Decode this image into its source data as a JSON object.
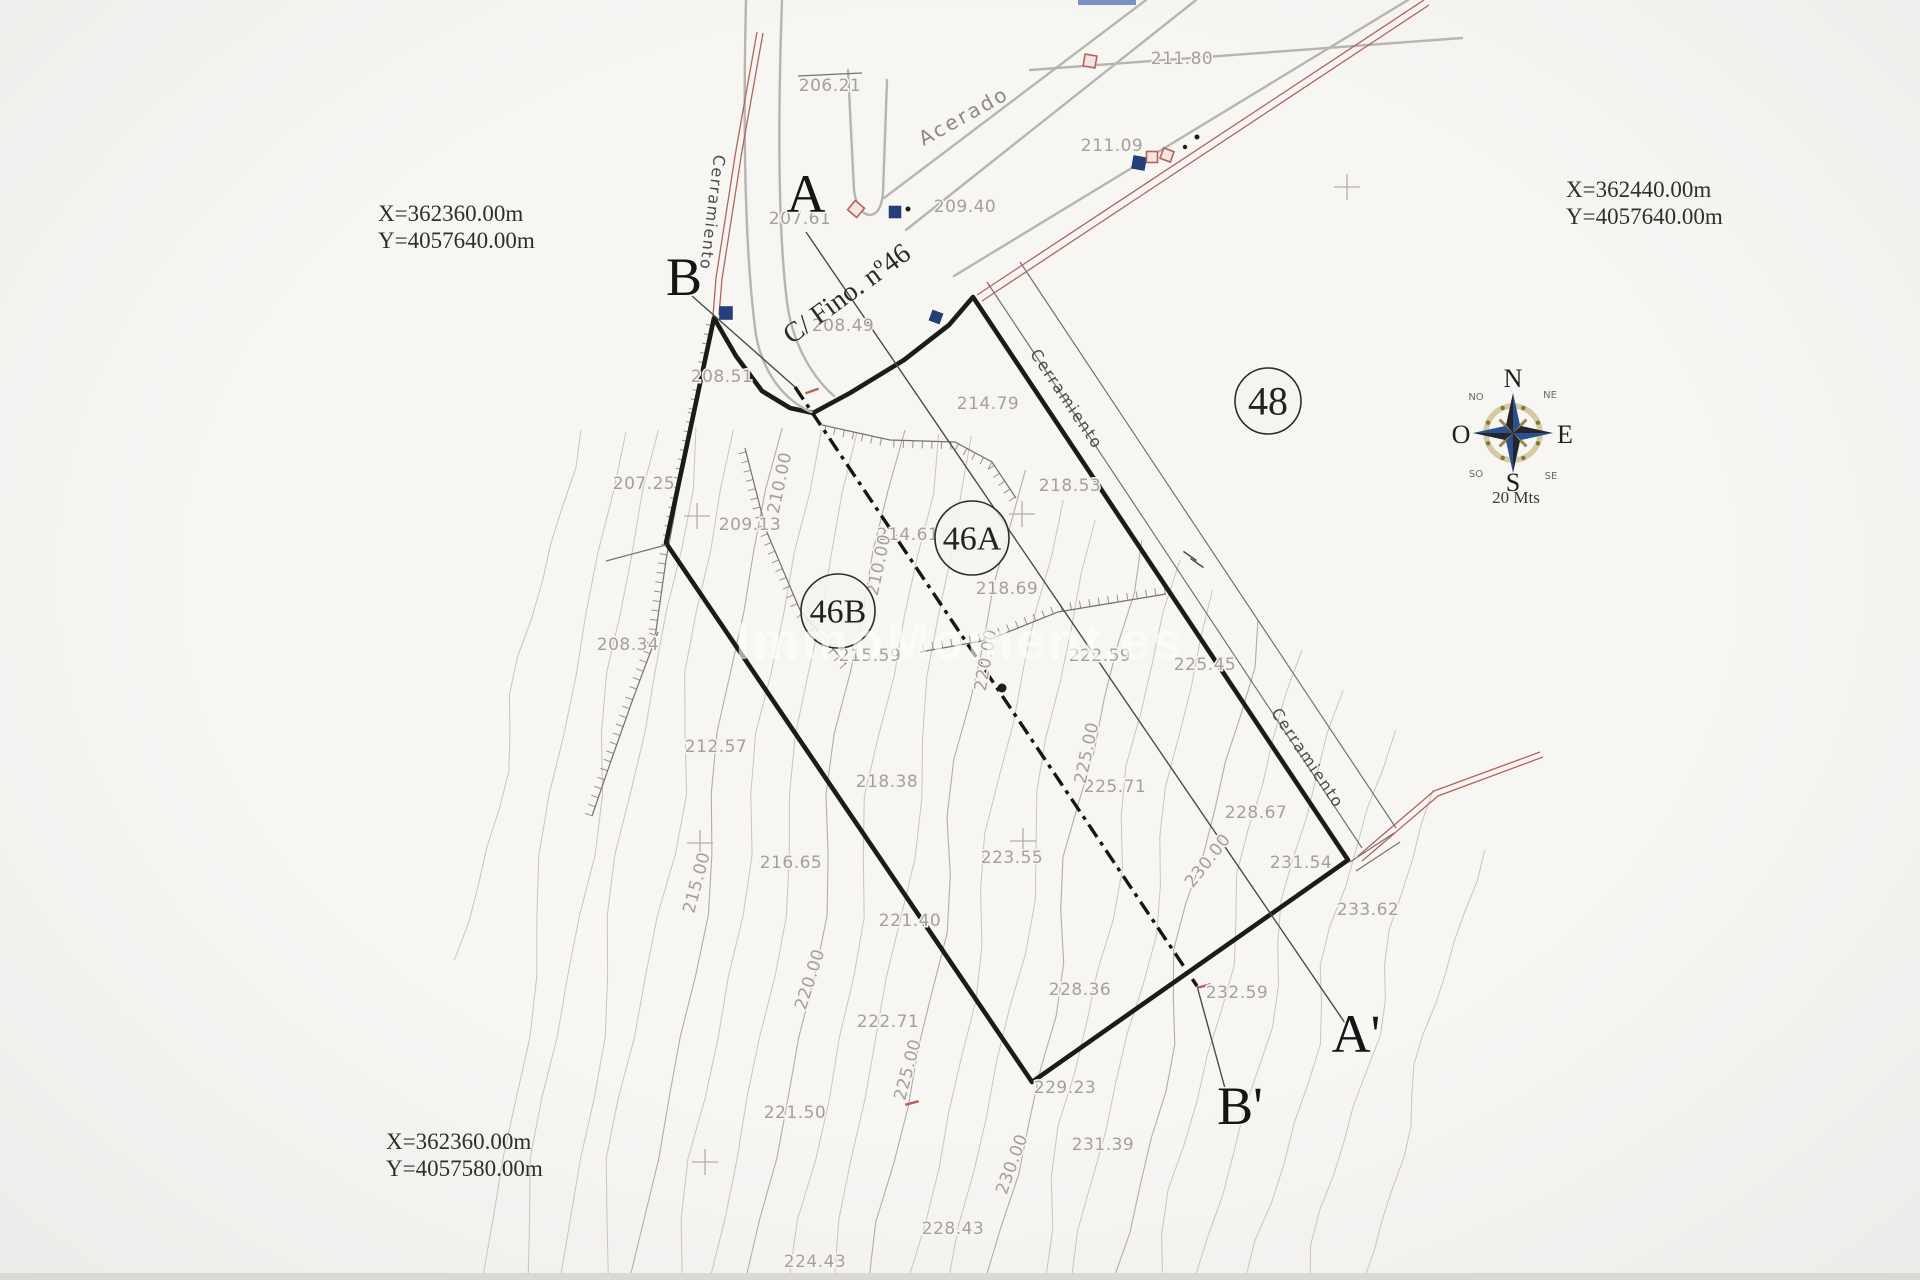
{
  "watermark": {
    "text": "ImmoMoment.es"
  },
  "coords": {
    "tl": {
      "x_label": "X=362360.00m",
      "y_label": "Y=4057640.00m"
    },
    "tr": {
      "x_label": "X=362440.00m",
      "y_label": "Y=4057640.00m"
    },
    "bl": {
      "x_label": "X=362360.00m",
      "y_label": "Y=4057580.00m"
    }
  },
  "compass": {
    "cx": 1513,
    "cy": 433,
    "cardinals": {
      "n": "N",
      "e": "E",
      "s": "S",
      "o": "O"
    },
    "intercardinals": {
      "no": "NO",
      "ne": "NE",
      "so": "SO",
      "se": "SE"
    },
    "scale_label": "20 Mts"
  },
  "colors": {
    "boundary": "#1b1b1b",
    "fence_red": "#b4635c",
    "marker_blue": "#23407c",
    "contour": "#c9c5bd",
    "paper": "#f4f3f0",
    "compass_blue": "#2c4f8f",
    "compass_gold": "#8a7433"
  },
  "parcel_circles": [
    {
      "label": "48",
      "x": 1268,
      "y": 401,
      "r": 33,
      "fs": 40
    },
    {
      "label": "46A",
      "x": 972,
      "y": 538,
      "r": 37,
      "fs": 34
    },
    {
      "label": "46B",
      "x": 838,
      "y": 611,
      "r": 37,
      "fs": 34
    }
  ],
  "section_letters": [
    {
      "label": "A",
      "x": 806,
      "y": 212
    },
    {
      "label": "B",
      "x": 684,
      "y": 295
    },
    {
      "label": "A'",
      "x": 1356,
      "y": 1052
    },
    {
      "label": "B'",
      "x": 1240,
      "y": 1124
    }
  ],
  "street_labels": [
    {
      "text": "Acerado",
      "x": 967,
      "y": 122,
      "rot": -29,
      "cls": "t-street"
    },
    {
      "text": "C/ Fino. nº46",
      "x": 852,
      "y": 301,
      "rot": -36,
      "cls": "t-fino"
    },
    {
      "text": "Cerramiento",
      "x": 707,
      "y": 212,
      "rot": 97,
      "cls": "t-cerr"
    },
    {
      "text": "Cerramiento",
      "x": 1062,
      "y": 402,
      "rot": 56,
      "cls": "t-cerr"
    },
    {
      "text": "Cerramiento",
      "x": 1303,
      "y": 761,
      "rot": 56,
      "cls": "t-cerr"
    }
  ],
  "spot_elevations": [
    {
      "v": "206.21",
      "x": 830,
      "y": 91
    },
    {
      "v": "211.80",
      "x": 1182,
      "y": 64
    },
    {
      "v": "211.09",
      "x": 1112,
      "y": 151
    },
    {
      "v": "209.40",
      "x": 965,
      "y": 212
    },
    {
      "v": "207.61",
      "x": 800,
      "y": 224
    },
    {
      "v": "208.49",
      "x": 843,
      "y": 331
    },
    {
      "v": "208.51",
      "x": 722,
      "y": 382
    },
    {
      "v": "214.79",
      "x": 988,
      "y": 409
    },
    {
      "v": "218.53",
      "x": 1070,
      "y": 491
    },
    {
      "v": "214.61",
      "x": 908,
      "y": 540
    },
    {
      "v": "207.25",
      "x": 644,
      "y": 489
    },
    {
      "v": "209.13",
      "x": 750,
      "y": 530
    },
    {
      "v": "208.34",
      "x": 628,
      "y": 650
    },
    {
      "v": "218.69",
      "x": 1007,
      "y": 594
    },
    {
      "v": "215.59",
      "x": 870,
      "y": 661
    },
    {
      "v": "222.59",
      "x": 1100,
      "y": 661
    },
    {
      "v": "225.45",
      "x": 1205,
      "y": 670
    },
    {
      "v": "212.57",
      "x": 716,
      "y": 752
    },
    {
      "v": "218.38",
      "x": 887,
      "y": 787
    },
    {
      "v": "225.71",
      "x": 1115,
      "y": 792
    },
    {
      "v": "228.67",
      "x": 1256,
      "y": 818
    },
    {
      "v": "223.55",
      "x": 1012,
      "y": 863
    },
    {
      "v": "216.65",
      "x": 791,
      "y": 868
    },
    {
      "v": "231.54",
      "x": 1301,
      "y": 868
    },
    {
      "v": "233.62",
      "x": 1368,
      "y": 915
    },
    {
      "v": "221.40",
      "x": 910,
      "y": 926
    },
    {
      "v": "232.59",
      "x": 1237,
      "y": 998
    },
    {
      "v": "228.36",
      "x": 1080,
      "y": 995
    },
    {
      "v": "222.71",
      "x": 888,
      "y": 1027
    },
    {
      "v": "229.23",
      "x": 1065,
      "y": 1093
    },
    {
      "v": "221.50",
      "x": 795,
      "y": 1118
    },
    {
      "v": "231.39",
      "x": 1103,
      "y": 1150
    },
    {
      "v": "228.43",
      "x": 953,
      "y": 1234
    },
    {
      "v": "224.43",
      "x": 815,
      "y": 1267
    }
  ],
  "contour_labels": [
    {
      "v": "210.00",
      "x": 785,
      "y": 484,
      "rot": -78
    },
    {
      "v": "210.00",
      "x": 884,
      "y": 566,
      "rot": -78
    },
    {
      "v": "215.00",
      "x": 702,
      "y": 884,
      "rot": -75
    },
    {
      "v": "220.00",
      "x": 991,
      "y": 661,
      "rot": -80
    },
    {
      "v": "220.00",
      "x": 815,
      "y": 981,
      "rot": -72
    },
    {
      "v": "225.00",
      "x": 1092,
      "y": 754,
      "rot": -78
    },
    {
      "v": "225.00",
      "x": 913,
      "y": 1071,
      "rot": -75
    },
    {
      "v": "230.00",
      "x": 1212,
      "y": 864,
      "rot": -52
    },
    {
      "v": "230.00",
      "x": 1017,
      "y": 1166,
      "rot": -70
    }
  ],
  "geometry": {
    "lines": [
      {
        "n": "parcel-boundary",
        "c": "s-bnd",
        "d": "M714 318 L736 356 L762 391 L790 408 L813 413 L850 393 L904 360 L949 325 L973 297 L1348 860 L1032 1082 L666 543 Z"
      },
      {
        "n": "street-edge-west-outer",
        "c": "s-road",
        "d": "M746 0 C743 130 745 255 756 335 C763 374 785 401 813 413"
      },
      {
        "n": "street-edge-west-inner",
        "c": "s-road",
        "d": "M782 0 C778 115 778 230 787 302 C792 340 809 374 834 396"
      },
      {
        "n": "street-turn-island",
        "c": "s-road",
        "d": "M848 70 L854 190 Q857 213 869 215 Q881 215 883 193 L887 80"
      },
      {
        "n": "road-north-edge",
        "c": "s-road",
        "d": "M884 198 L1146 0"
      },
      {
        "n": "road-south-edge",
        "c": "s-road",
        "d": "M906 230 L1196 0"
      },
      {
        "n": "sidewalk-line",
        "c": "s-road",
        "d": "M954 276 L1408 0"
      },
      {
        "n": "upper-fence-line",
        "c": "s-road",
        "d": "M1030 70 L1462 38"
      },
      {
        "n": "plot-line-206",
        "c": "s-thin",
        "d": "M798 76 L862 73"
      },
      {
        "n": "ne-offset-line-1",
        "c": "s-thin",
        "d": "M987 282 L1362 848"
      },
      {
        "n": "ne-offset-line-2",
        "c": "s-thin",
        "d": "M1020 262 L1396 828"
      },
      {
        "n": "corner-step-1",
        "c": "s-thin",
        "d": "M1350 862 L1394 833"
      },
      {
        "n": "corner-step-2",
        "c": "s-thin",
        "d": "M1356 871 L1400 842"
      },
      {
        "n": "west-corner-spur",
        "c": "s-thin",
        "d": "M666 545 L606 561"
      },
      {
        "n": "red-fence-west-1",
        "c": "s-red",
        "d": "M757 32 L736 150 L716 278 L713 316"
      },
      {
        "n": "red-fence-west-2",
        "c": "s-red",
        "d": "M763 33 L742 151 L722 279 L719 315"
      },
      {
        "n": "red-fence-ne-1",
        "c": "s-red",
        "d": "M977 295 L1424 0"
      },
      {
        "n": "red-fence-ne-2",
        "c": "s-red",
        "d": "M982 301 L1429 5"
      },
      {
        "n": "red-fence-east-1",
        "c": "s-red",
        "d": "M1358 856 L1434 791 L1540 752"
      },
      {
        "n": "red-fence-east-2",
        "c": "s-red",
        "d": "M1362 861 L1438 796 L1543 757"
      },
      {
        "n": "section-line-a",
        "c": "s-sec",
        "d": "M806 232 L1345 1023"
      },
      {
        "n": "section-line-b-upper",
        "c": "s-sec",
        "d": "M692 296 L795 387"
      },
      {
        "n": "section-line-b-dashed",
        "c": "s-dash",
        "d": "M795 387 L1197 986"
      },
      {
        "n": "section-line-b-lower",
        "c": "s-sec",
        "d": "M1197 986 L1226 1092"
      }
    ],
    "ticked": [
      {
        "n": "west-bank",
        "side": 1,
        "pts": [
          [
            714,
            322
          ],
          [
            696,
            410
          ],
          [
            678,
            495
          ],
          [
            666,
            560
          ],
          [
            655,
            638
          ]
        ]
      },
      {
        "n": "north-bank",
        "side": 1,
        "pts": [
          [
            822,
            425
          ],
          [
            890,
            440
          ],
          [
            955,
            442
          ],
          [
            992,
            462
          ],
          [
            1016,
            498
          ]
        ]
      },
      {
        "n": "mid-bank",
        "side": -1,
        "pts": [
          [
            920,
            652
          ],
          [
            988,
            640
          ],
          [
            1058,
            612
          ],
          [
            1124,
            601
          ],
          [
            1166,
            594
          ]
        ]
      },
      {
        "n": "inner-west-bank",
        "side": 1,
        "pts": [
          [
            745,
            448
          ],
          [
            766,
            530
          ],
          [
            800,
            610
          ],
          [
            846,
            664
          ]
        ]
      },
      {
        "n": "lower-west-bank",
        "side": 1,
        "pts": [
          [
            658,
            632
          ],
          [
            634,
            696
          ],
          [
            612,
            758
          ],
          [
            592,
            816
          ]
        ]
      }
    ],
    "contours": [
      [
        575,
        430,
        460,
        960,
        7,
        1.6,
        0.5,
        0
      ],
      [
        615,
        432,
        482,
        1280,
        8,
        1.4,
        1.1,
        0
      ],
      [
        653,
        430,
        520,
        1280,
        7,
        1.8,
        2.0,
        0
      ],
      [
        693,
        428,
        558,
        1280,
        8,
        1.5,
        0.2,
        0
      ],
      [
        733,
        430,
        598,
        1280,
        9,
        1.7,
        2.6,
        0
      ],
      [
        775,
        428,
        640,
        1280,
        8,
        1.5,
        1.9,
        1
      ],
      [
        813,
        430,
        678,
        1280,
        7,
        1.9,
        0.8,
        0
      ],
      [
        853,
        432,
        718,
        1280,
        8,
        1.4,
        2.2,
        0
      ],
      [
        893,
        430,
        758,
        1280,
        9,
        1.6,
        1.4,
        1
      ],
      [
        933,
        434,
        798,
        1280,
        8,
        1.8,
        0.4,
        0
      ],
      [
        973,
        436,
        838,
        1280,
        7,
        1.5,
        2.9,
        0
      ],
      [
        1013,
        470,
        878,
        1280,
        9,
        1.7,
        1.2,
        1
      ],
      [
        1053,
        500,
        918,
        1280,
        8,
        1.6,
        0.9,
        0
      ],
      [
        1093,
        520,
        958,
        1280,
        8,
        1.5,
        2.4,
        0
      ],
      [
        1133,
        540,
        998,
        1280,
        9,
        1.7,
        0.6,
        1
      ],
      [
        1173,
        560,
        1038,
        1280,
        7,
        1.9,
        1.8,
        0
      ],
      [
        1213,
        590,
        1078,
        1280,
        8,
        1.5,
        2.7,
        0
      ],
      [
        1253,
        620,
        1118,
        1280,
        9,
        1.6,
        0.3,
        1
      ],
      [
        1293,
        650,
        1158,
        1280,
        7,
        1.8,
        1.5,
        0
      ],
      [
        1338,
        690,
        1205,
        1280,
        8,
        1.5,
        2.1,
        0
      ],
      [
        1385,
        730,
        1255,
        1280,
        8,
        1.7,
        1.0,
        0
      ],
      [
        1432,
        790,
        1310,
        1280,
        7,
        1.6,
        2.5,
        0
      ],
      [
        1478,
        850,
        1365,
        1280,
        6,
        1.5,
        0.7,
        0
      ]
    ],
    "markers": {
      "blue_squares": [
        [
          726,
          313,
          13,
          0
        ],
        [
          895,
          212,
          12,
          0
        ],
        [
          936,
          317,
          11,
          20
        ],
        [
          1139,
          163,
          13,
          10
        ]
      ],
      "red_squares": [
        [
          856,
          209,
          12,
          40
        ],
        [
          1090,
          61,
          12,
          10
        ],
        [
          1152,
          157,
          11,
          0
        ],
        [
          1167,
          155,
          11,
          20
        ]
      ],
      "dots": [
        [
          1002,
          688,
          4.5
        ],
        [
          908,
          209,
          2.5
        ],
        [
          1185,
          147,
          2.2
        ],
        [
          1197,
          137,
          2.5
        ]
      ],
      "red_dashes": [
        [
          812,
          391,
          14,
          -20
        ],
        [
          1204,
          986,
          14,
          -15
        ],
        [
          912,
          1103,
          14,
          -15
        ]
      ],
      "dark_dashes": [
        [
          1190,
          556,
          16,
          35
        ],
        [
          1197,
          563,
          16,
          35
        ]
      ],
      "crosses": [
        [
          1347,
          187
        ],
        [
          697,
          516
        ],
        [
          1022,
          514
        ],
        [
          700,
          843
        ],
        [
          1023,
          841
        ],
        [
          705,
          1162
        ]
      ]
    }
  }
}
